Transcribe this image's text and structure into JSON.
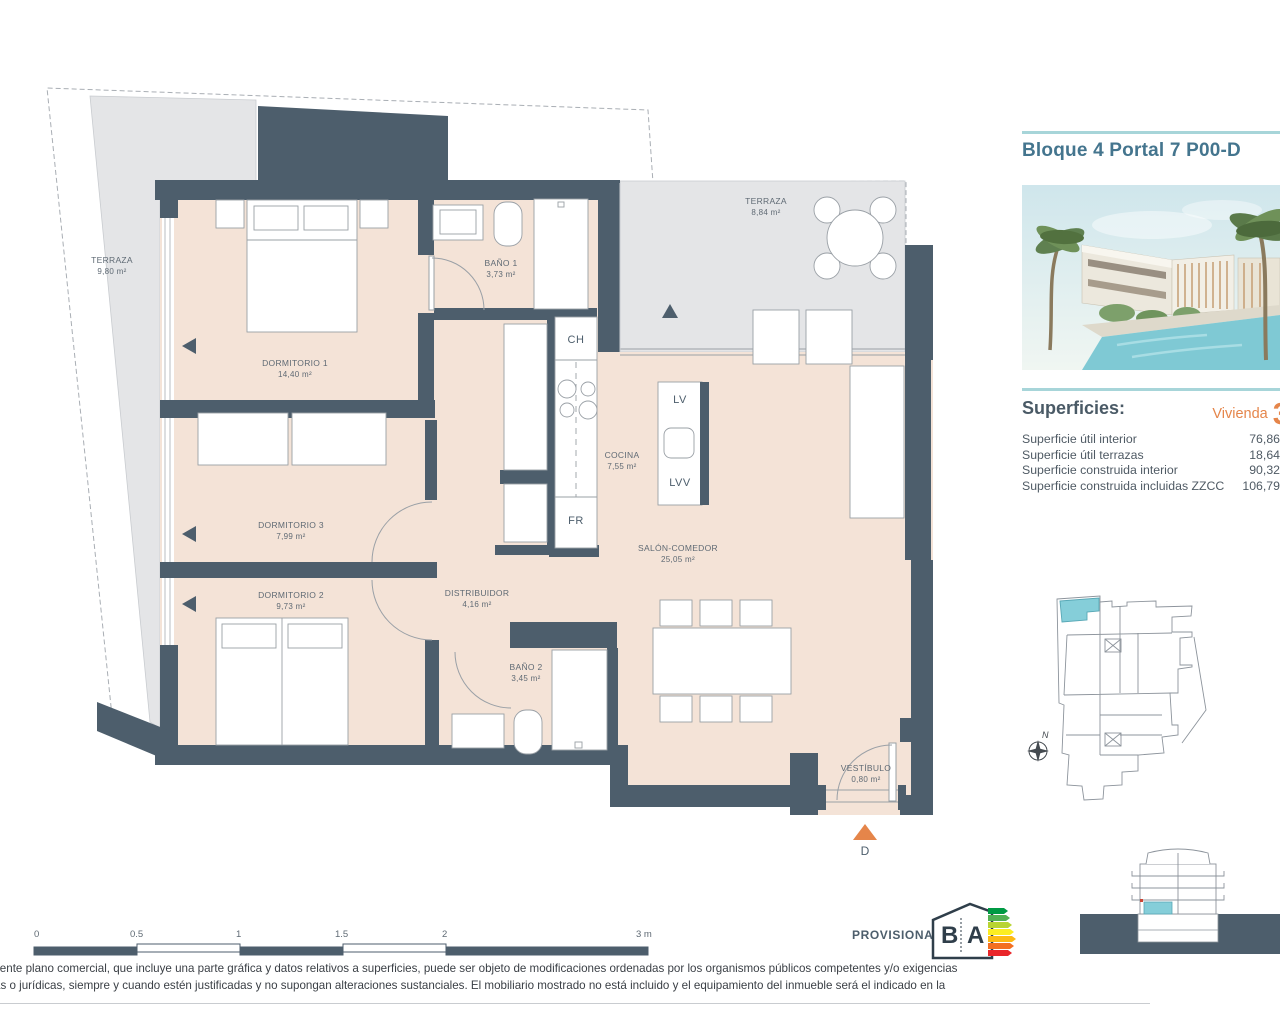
{
  "info_panel": {
    "title": "Bloque 4 Portal 7 P00-D",
    "superficies_heading": "Superficies:",
    "vivienda_label": "Vivienda",
    "vivienda_number": "3",
    "surface_rows": [
      {
        "label": "Superficie útil interior",
        "value": "76,86"
      },
      {
        "label": "Superficie útil terrazas",
        "value": "18,64"
      },
      {
        "label": "Superficie construida interior",
        "value": "90,32"
      },
      {
        "label": "Superficie construida incluidas ZZCC",
        "value": "106,79"
      }
    ],
    "compass_label": "N"
  },
  "floor_plan": {
    "rooms": [
      {
        "name": "TERRAZA",
        "area": "9,80 m²"
      },
      {
        "name": "DORMITORIO 1",
        "area": "14,40 m²"
      },
      {
        "name": "BAÑO 1",
        "area": "3,73 m²"
      },
      {
        "name": "TERRAZA",
        "area": "8,84 m²"
      },
      {
        "name": "COCINA",
        "area": "7,55 m²"
      },
      {
        "name": "DORMITORIO 3",
        "area": "7,99 m²"
      },
      {
        "name": "DORMITORIO 2",
        "area": "9,73 m²"
      },
      {
        "name": "DISTRIBUIDOR",
        "area": "4,16 m²"
      },
      {
        "name": "BAÑO 2",
        "area": "3,45 m²"
      },
      {
        "name": "SALÓN-COMEDOR",
        "area": "25,05 m²"
      },
      {
        "name": "VESTÍBULO",
        "area": "0,80 m²"
      }
    ],
    "appliance_labels": {
      "ch": "CH",
      "lv": "LV",
      "lvv": "LVV",
      "fr": "FR"
    },
    "entrance_marker": "D"
  },
  "scale_bar": {
    "ticks": [
      "0",
      "0.5",
      "1",
      "1.5",
      "2",
      "3 m"
    ]
  },
  "footer": {
    "provisional_label": "PROVISIONAL",
    "energy_letter_b": "B",
    "energy_letter_a": "A",
    "disclaimer_line1": "sente plano comercial, que incluye una parte gráfica y datos relativos a superficies, puede ser objeto de modificaciones ordenadas por los organismos públicos competentes y/o exigencias",
    "disclaimer_line2": "as o jurídicas, siempre y cuando estén justificadas y no supongan alteraciones sustanciales. El mobiliario mostrado no está incluido y el equipamiento del inmueble será el indicado en la"
  },
  "colors": {
    "wall": "#4d5e6c",
    "floor": "#f4e3d7",
    "terrace": "#e4e5e7",
    "accent_teal": "#85ced9",
    "accent_orange": "#e5854a",
    "title_blue": "#44758e"
  }
}
